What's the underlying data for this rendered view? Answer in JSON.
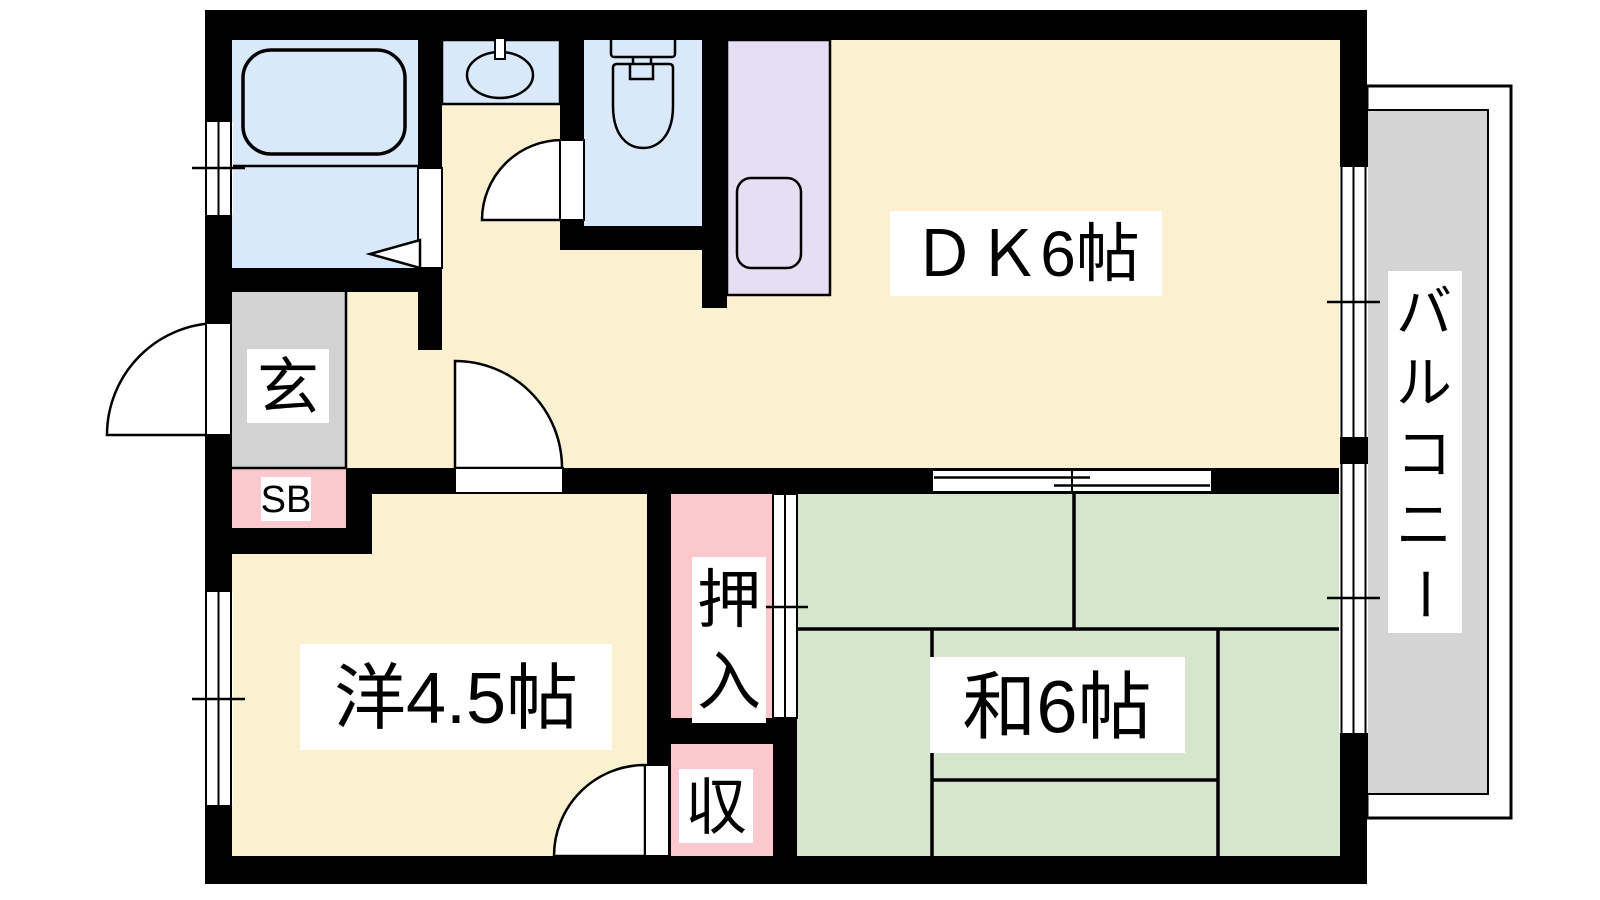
{
  "page": {
    "title": "間取り図 (apartment floor plan)"
  },
  "colors": {
    "wall": "#000000",
    "floor": "#FBF0D0",
    "tatami": "#D6E5CE",
    "water": "#D9E8FA",
    "kitchen": "#E6DEF2",
    "closet": "#FBC8CE",
    "entry_gray": "#D2D2D2",
    "balcony_gray": "#D4D4D4",
    "label_bg": "#FFFFFF",
    "line": "#000000"
  },
  "rooms": {
    "dk": {
      "label": "ＤＫ6帖"
    },
    "washitsu": {
      "label": "和6帖"
    },
    "youshitsu": {
      "label": "洋4.5帖"
    },
    "oshiire": {
      "label": "押入",
      "chars": [
        "押",
        "入"
      ]
    },
    "shunou": {
      "label": "収"
    },
    "genkan": {
      "label": "玄"
    },
    "shoebox": {
      "label": "SB"
    },
    "balcony": {
      "label": "バルコニー",
      "chars": [
        "バ",
        "ル",
        "コ",
        "ニ",
        "ー"
      ]
    }
  },
  "fixtures": {
    "bathtub": "bathtub",
    "washbasin": "washbasin",
    "toilet": "toilet",
    "kitchen_sink": "kitchen-sink",
    "tatami_mats": "tatami-mats",
    "doors": "hinged-door-arcs",
    "windows": "sliding-window-symbols"
  }
}
